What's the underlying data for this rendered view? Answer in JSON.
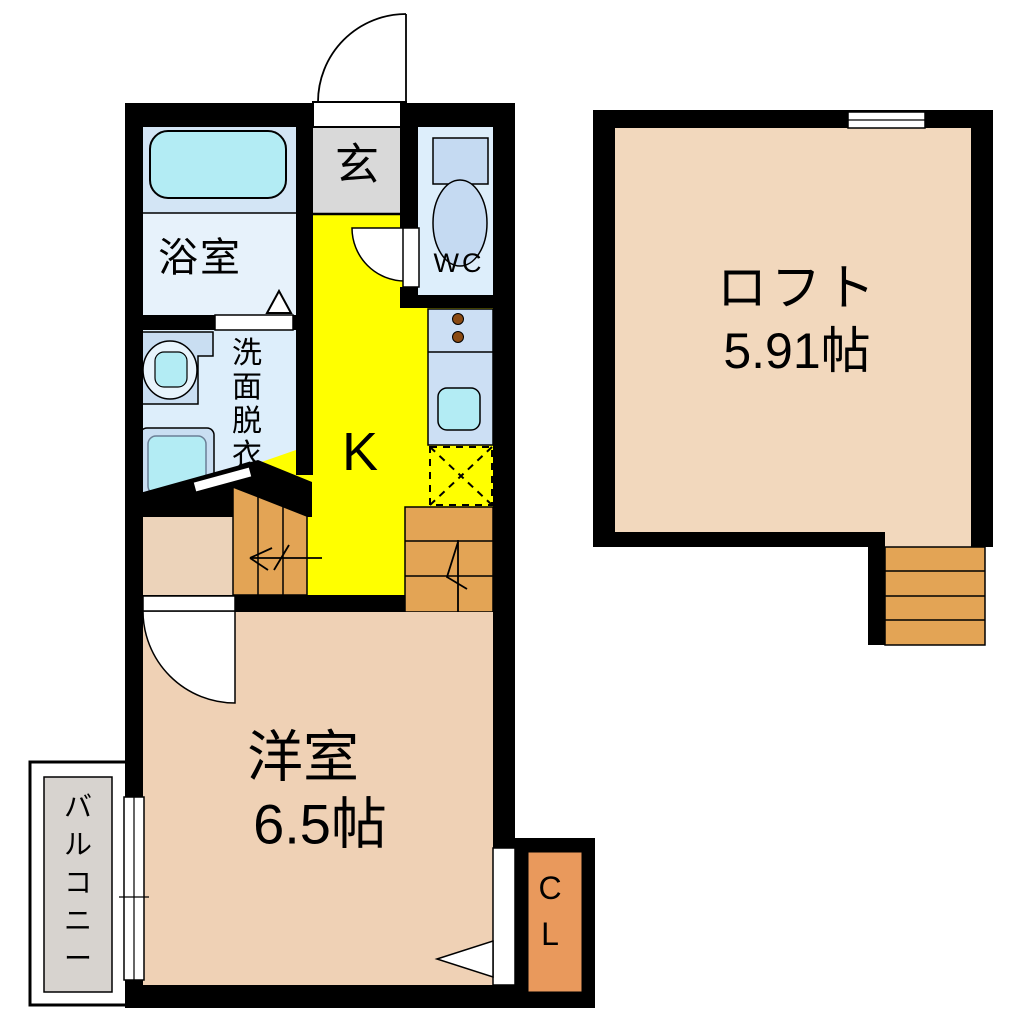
{
  "title": "1K ロフト付き 間取り図",
  "colors": {
    "wall": "#000000",
    "kitchen-floor": "#ffff00",
    "entrance-floor": "#d9d9d9",
    "bathroom-floor-upper": "#d3e5f5",
    "bathroom-floor-lower": "#e7f2fb",
    "wc-floor": "#ddeefb",
    "washroom-floor": "#ddeefb",
    "fixture-blue": "#c9def2",
    "fixture-cyan": "#b3ecf4",
    "toilet-blue": "#c5daf2",
    "counter-blue": "#ccdff4",
    "room-floor": "#efd1b5",
    "landing-floor": "#ecd3ba",
    "loft-floor": "#f2d8bd",
    "stairs-orange": "#e3a455",
    "closet-orange": "#e9995c",
    "balcony-gray": "#d7d3cf",
    "knob-brown": "#8a4a12"
  },
  "rooms": {
    "bathroom": {
      "label": "浴室"
    },
    "entrance": {
      "label": "玄"
    },
    "wc": {
      "label": "WC"
    },
    "washroom": {
      "label": "洗面脱衣所"
    },
    "kitchen": {
      "label": "K"
    },
    "western_room": {
      "label": "洋室",
      "size": "6.5帖"
    },
    "loft": {
      "label": "ロフト",
      "size": "5.91帖"
    },
    "balcony": {
      "label": "バルコニー"
    },
    "closet": {
      "label": "CL"
    }
  }
}
